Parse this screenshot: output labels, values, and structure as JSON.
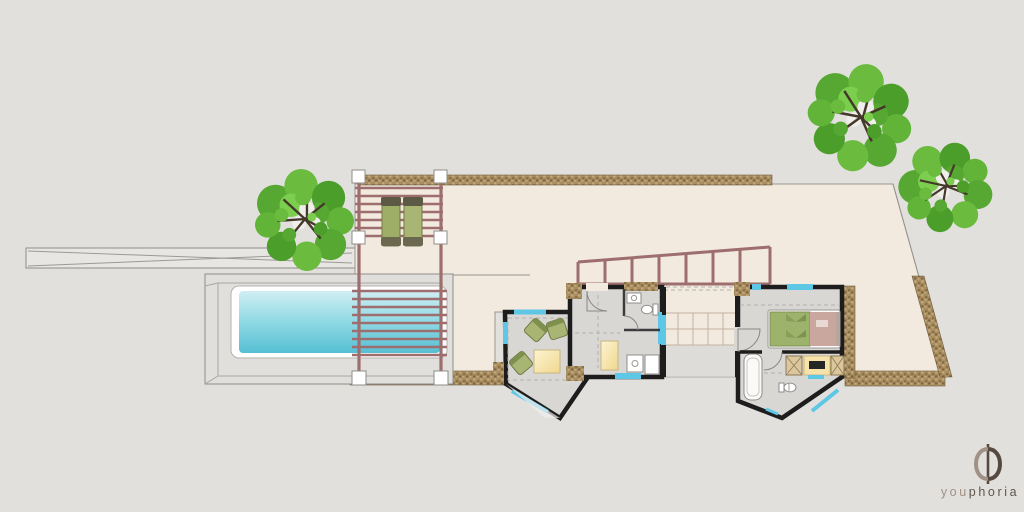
{
  "page": {
    "type": "architectural-site-plan",
    "description": "Top-down villa floor plan with terrace, swimming pool, two pergolas, living wing, hallway with bathroom, staircase, bedroom with en-suite, garden trees and studio logo"
  },
  "branding": {
    "symbol": "phi",
    "name_light": "you",
    "name_dark": "phoria",
    "full_name": "youphoria"
  },
  "palette": {
    "background": "#e2e0dd",
    "terrace": "#f2e9df",
    "tan_border": "#a88d60",
    "deck": "#e1dfdc",
    "pool_water_top": "#cfeef3",
    "pool_water_bottom": "#55bfd4",
    "pool_frame": "#ffffff",
    "pergola": "#9e6e6e",
    "wall": "#1d1d1d",
    "room_floor": "#d9d7d4",
    "window": "#5ec7e6",
    "chair_green": "#a8b573",
    "bed_green": "#9db26b",
    "bed_pink": "#c9a69e",
    "table_yellow": "#f7e3a9",
    "tree_green": "#57a832",
    "logo_light": "#a09185",
    "logo_dark": "#564a40"
  },
  "features": [
    "driveway-ramp",
    "terrace",
    "upper-pergola",
    "sun-loungers",
    "swimming-pool",
    "pool-deck",
    "pool-pergola",
    "bedroom-railing",
    "living-room",
    "armchairs",
    "coffee-table",
    "hallway",
    "bathroom",
    "kitchen-counter",
    "staircase",
    "bedroom",
    "double-bed",
    "ensuite-bathroom",
    "bathtub",
    "vanity",
    "garden-tree-west",
    "garden-tree-northeast",
    "garden-tree-east",
    "youphoria-logo"
  ]
}
